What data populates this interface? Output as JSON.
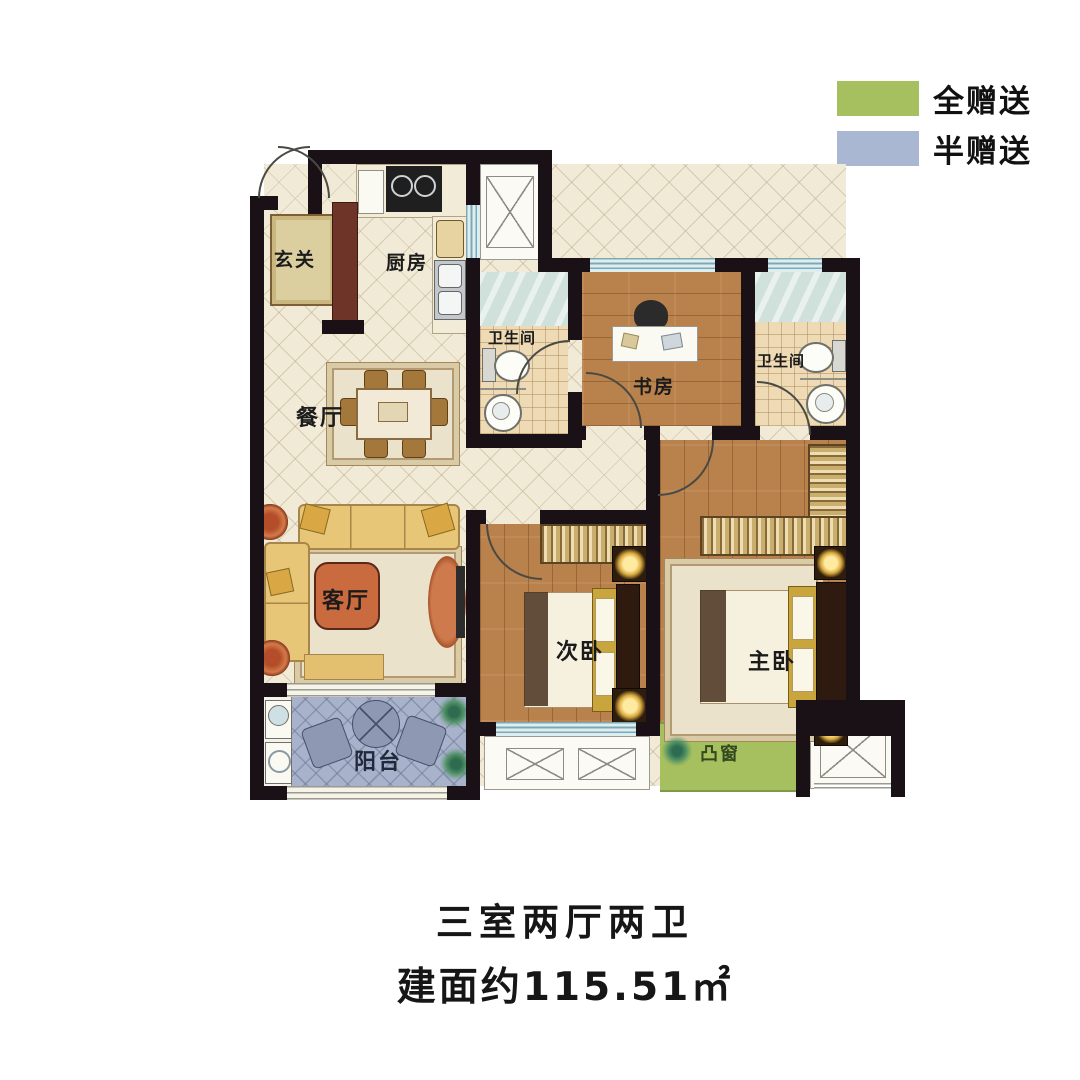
{
  "legend": {
    "items": [
      {
        "label": "全赠送",
        "color": "#a6bf5f"
      },
      {
        "label": "半赠送",
        "color": "#a9b7d3"
      }
    ]
  },
  "rooms": {
    "entry": "玄关",
    "kitchen": "厨房",
    "dining": "餐厅",
    "living": "客厅",
    "bath1": "卫生间",
    "study": "书房",
    "bath2": "卫生间",
    "bedroom2": "次卧",
    "master": "主卧",
    "balcony": "阳台",
    "bay_window": "凸窗"
  },
  "title": {
    "layout": "三室两厅两卫",
    "area": "建面约115.51㎡"
  },
  "colors": {
    "wall": "#1a1116",
    "floor_cream": "#f1ead6",
    "wood": "#b9824c",
    "tile": "#eedab5",
    "shower_glass": "#cfe1da",
    "balcony": "#a8b3cb",
    "bay_window": "#a6bf5f"
  }
}
